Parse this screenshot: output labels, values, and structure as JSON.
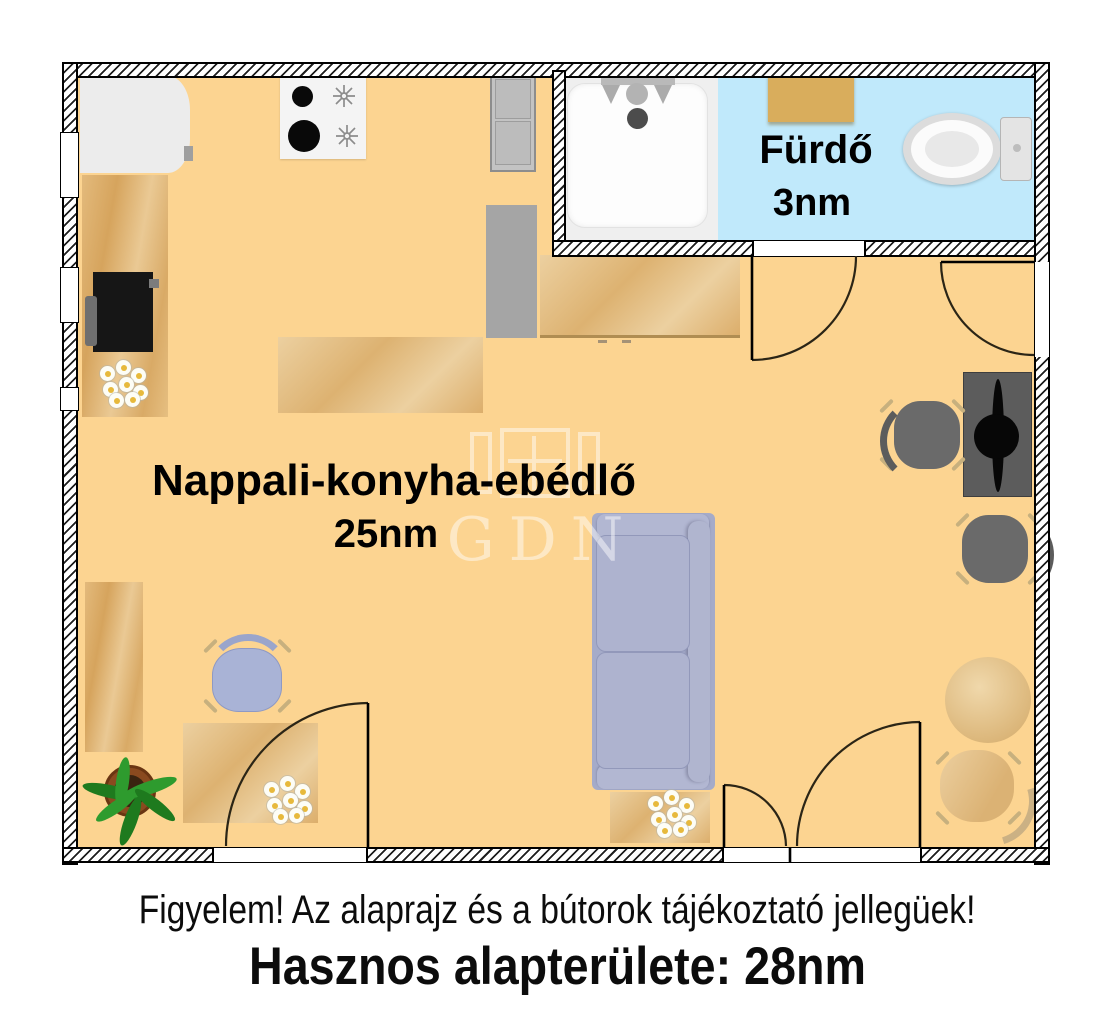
{
  "plan": {
    "rooms": [
      {
        "id": "living_kitchen_dining",
        "name": "Nappali-konyha-ebédlő",
        "area": "25nm"
      },
      {
        "id": "bathroom",
        "name": "Fürdő",
        "area": "3nm"
      }
    ],
    "watermark_text": "GDN",
    "furniture_icons": [
      "wardrobe-icon",
      "stove-icon",
      "fridge-icon",
      "cabinet-icon",
      "kitchen-counter-icon",
      "tv-appliance-icon",
      "flowers-icon",
      "coffee-table-icon",
      "sofa-icon",
      "side-table-icon",
      "dining-table-icon",
      "chair-icon",
      "office-chair-icon",
      "desk-icon",
      "monitor-icon",
      "round-table-icon",
      "wooden-chair-icon",
      "plant-icon",
      "shower-icon",
      "washbasin-icon",
      "toilet-icon"
    ],
    "colors": {
      "floor": "#fcd491",
      "bathroom_floor": "#c0e9fb",
      "shower_zone": "#efefef",
      "wood": "#ddb271",
      "sofa": "#a8aecb",
      "sink_cabinet": "#d9ad5c",
      "wall_line": "#000000"
    }
  },
  "captions": {
    "disclaimer": "Figyelem! Az alaprajz és a bútorok tájékoztató jellegüek!",
    "total_area": "Hasznos alapterülete: 28nm"
  }
}
